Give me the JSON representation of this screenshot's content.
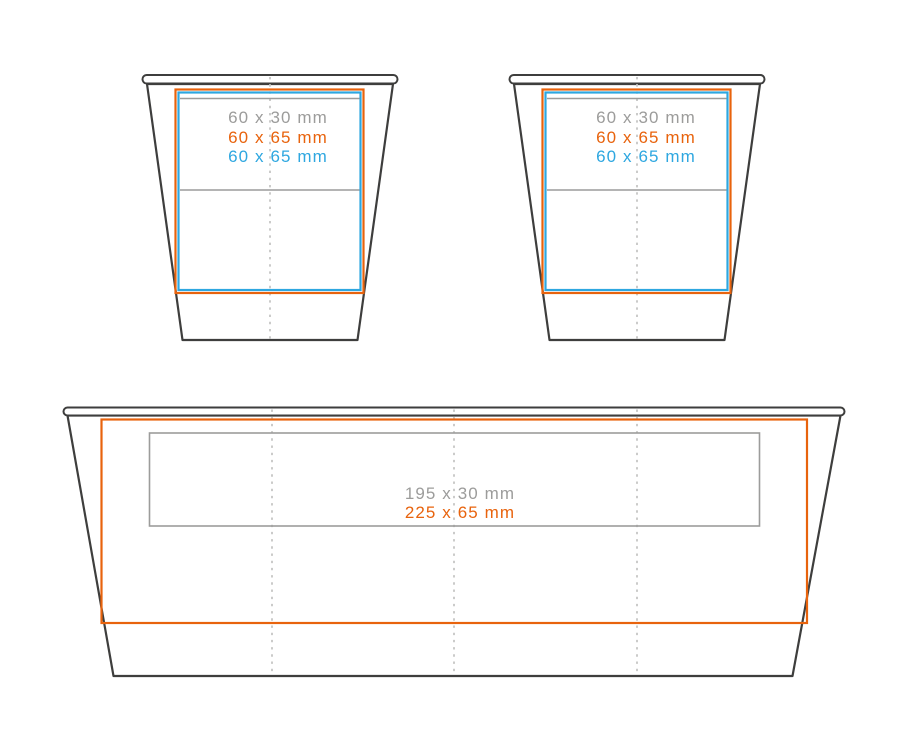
{
  "diagram_title": "cup-print-area-template",
  "colors": {
    "outline": "#3E3E3D",
    "gray": "#9C9C9B",
    "orange": "#E8630D",
    "blue": "#2EA7E0",
    "fold_line": "#CBCBCA"
  },
  "cup_small_left": {
    "line1": "60 x 30 mm",
    "line2": "60 x 65 mm",
    "line3": "60 x 65 mm"
  },
  "cup_small_right": {
    "line1": "60 x 30 mm",
    "line2": "60 x 65 mm",
    "line3": "60 x 65 mm"
  },
  "cup_large": {
    "line1": "195 x 30 mm",
    "line2": "225 x 65 mm"
  }
}
